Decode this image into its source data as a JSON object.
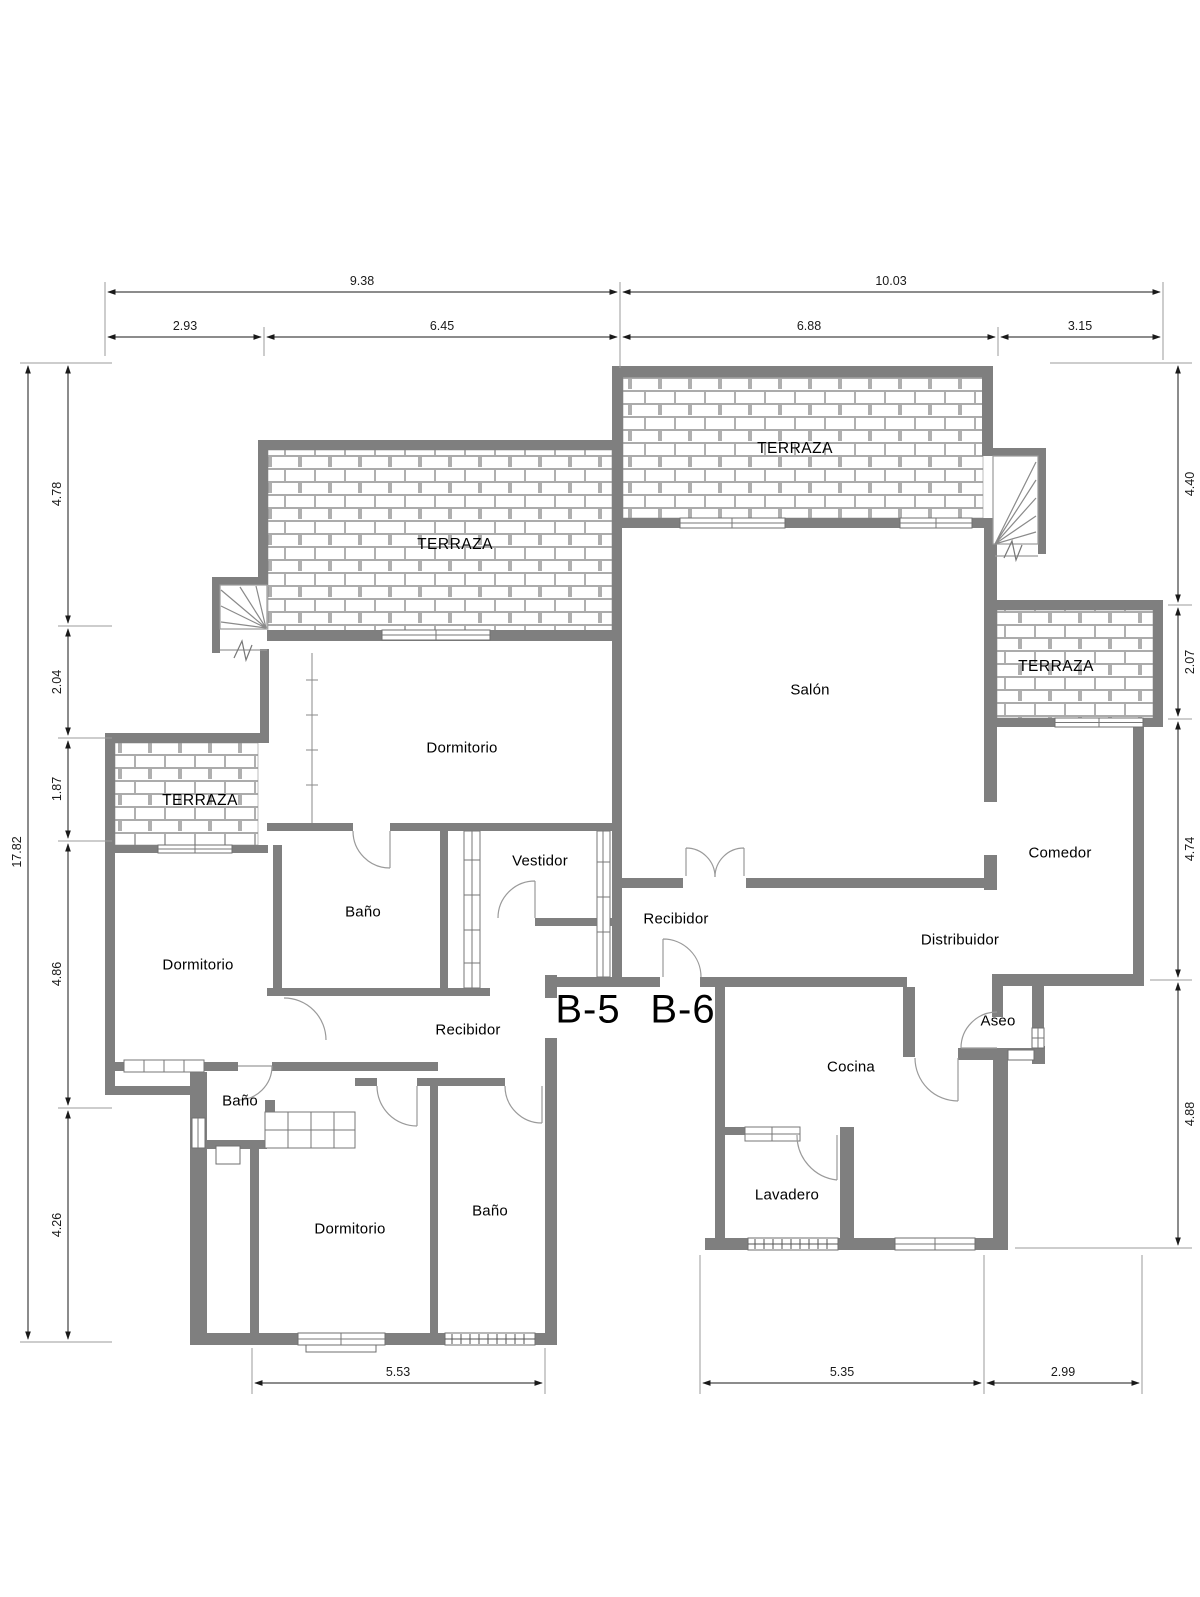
{
  "plan": {
    "terraces": [
      {
        "id": "terraza-top-left",
        "label": "TERRAZA"
      },
      {
        "id": "terraza-top-right",
        "label": "TERRAZA"
      },
      {
        "id": "terraza-right",
        "label": "TERRAZA"
      },
      {
        "id": "terraza-left",
        "label": "TERRAZA"
      }
    ],
    "rooms": [
      {
        "id": "dormitorio-top",
        "label": "Dormitorio"
      },
      {
        "id": "salon",
        "label": "Salón"
      },
      {
        "id": "vestidor",
        "label": "Vestidor"
      },
      {
        "id": "bano-principal",
        "label": "Baño"
      },
      {
        "id": "recibidor-b6",
        "label": "Recibidor"
      },
      {
        "id": "comedor",
        "label": "Comedor"
      },
      {
        "id": "distribuidor",
        "label": "Distribuidor"
      },
      {
        "id": "dormitorio-left",
        "label": "Dormitorio"
      },
      {
        "id": "recibidor-b5",
        "label": "Recibidor"
      },
      {
        "id": "aseo",
        "label": "Aseo"
      },
      {
        "id": "cocina",
        "label": "Cocina"
      },
      {
        "id": "bano-left",
        "label": "Baño"
      },
      {
        "id": "lavadero",
        "label": "Lavadero"
      },
      {
        "id": "dormitorio-bottom",
        "label": "Dormitorio"
      },
      {
        "id": "bano-bottom",
        "label": "Baño"
      }
    ],
    "units": [
      {
        "id": "unit-b5",
        "label": "B-5"
      },
      {
        "id": "unit-b6",
        "label": "B-6"
      }
    ]
  },
  "dimensions": {
    "top_outer": [
      "9.38",
      "10.03"
    ],
    "top_inner": [
      "2.93",
      "6.45",
      "6.88",
      "3.15"
    ],
    "left_outer": [
      "17.82"
    ],
    "left_inner": [
      "4.78",
      "2.04",
      "1.87",
      "4.86",
      "4.26"
    ],
    "right": [
      "4.40",
      "2.07",
      "4.74",
      "4.88"
    ],
    "bottom": [
      "5.53",
      "5.35",
      "2.99"
    ]
  },
  "colors": {
    "wall": "#7f7f7f",
    "hatch_line": "#8f8f8f",
    "dim_line": "#3c3c3c",
    "door_arc": "#9a9a9a",
    "text": "#000000"
  }
}
